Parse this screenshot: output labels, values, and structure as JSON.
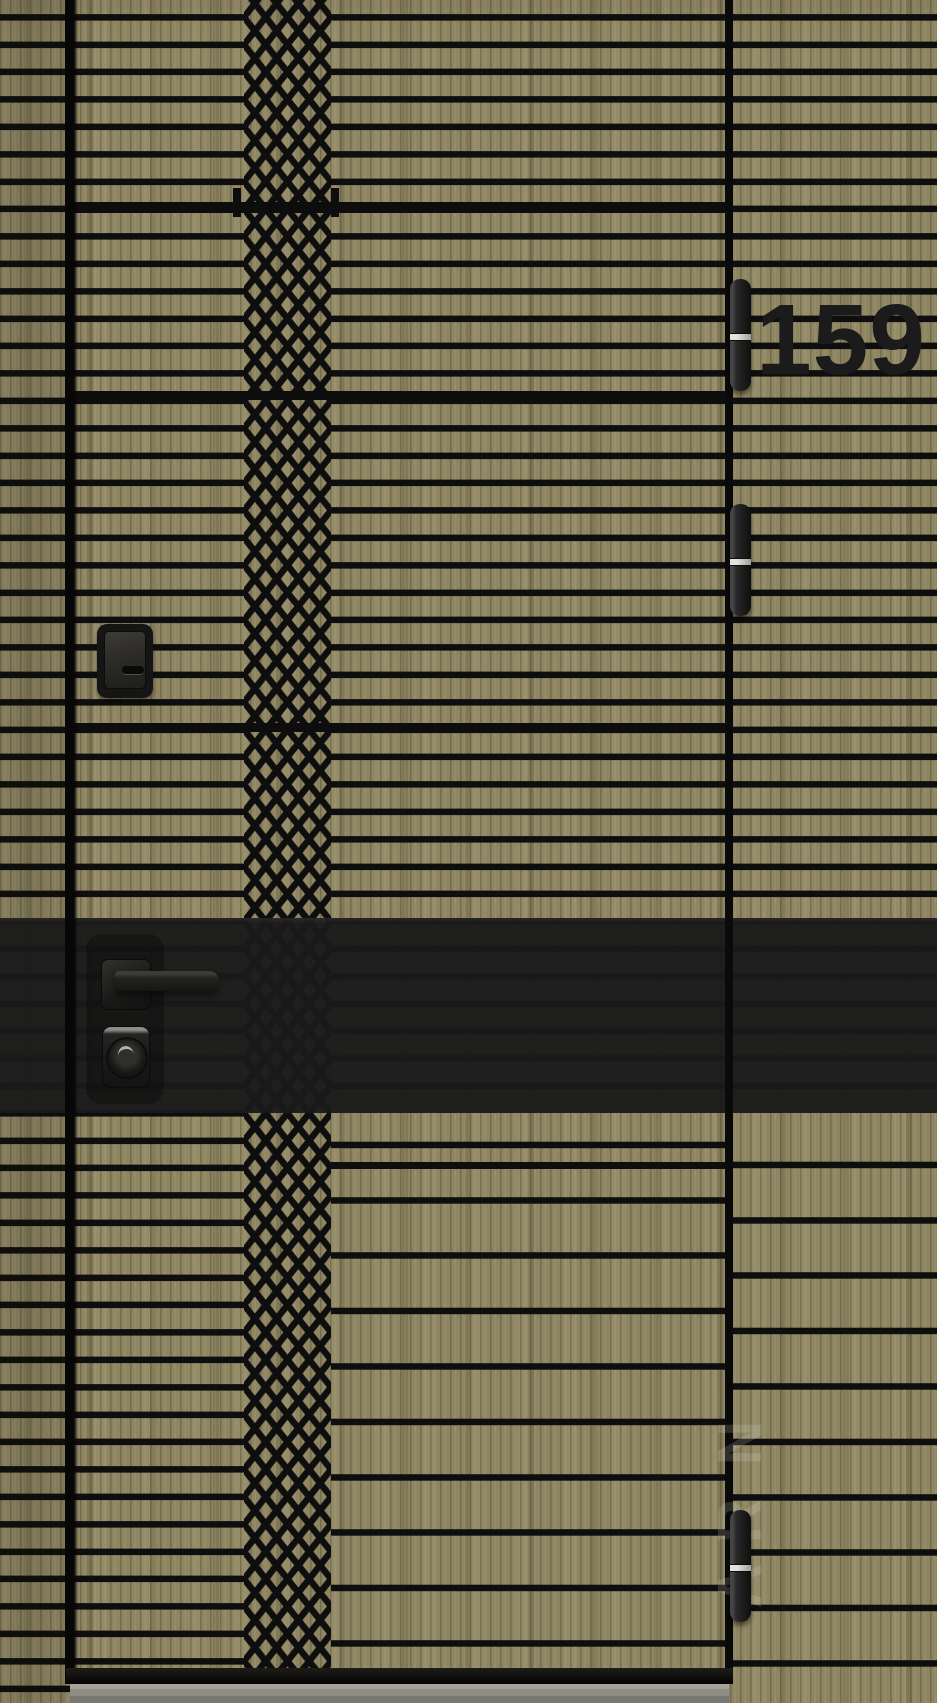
{
  "house_number": "159",
  "watermark": {
    "letters": [
      {
        "char": "N"
      },
      {
        "char": "R"
      },
      {
        "char": "A"
      }
    ]
  },
  "colors": {
    "wood_base": "#8e8562",
    "groove_black": "#0e0e0e",
    "accent_band": "#1a1a1a",
    "hinge_metal": "#242424",
    "hinge_ring_silver": "#c6c6c2",
    "hardware_black": "#1e1e1d",
    "threshold_gray": "#8e8c85",
    "house_number_color": "#1b1b1b"
  }
}
